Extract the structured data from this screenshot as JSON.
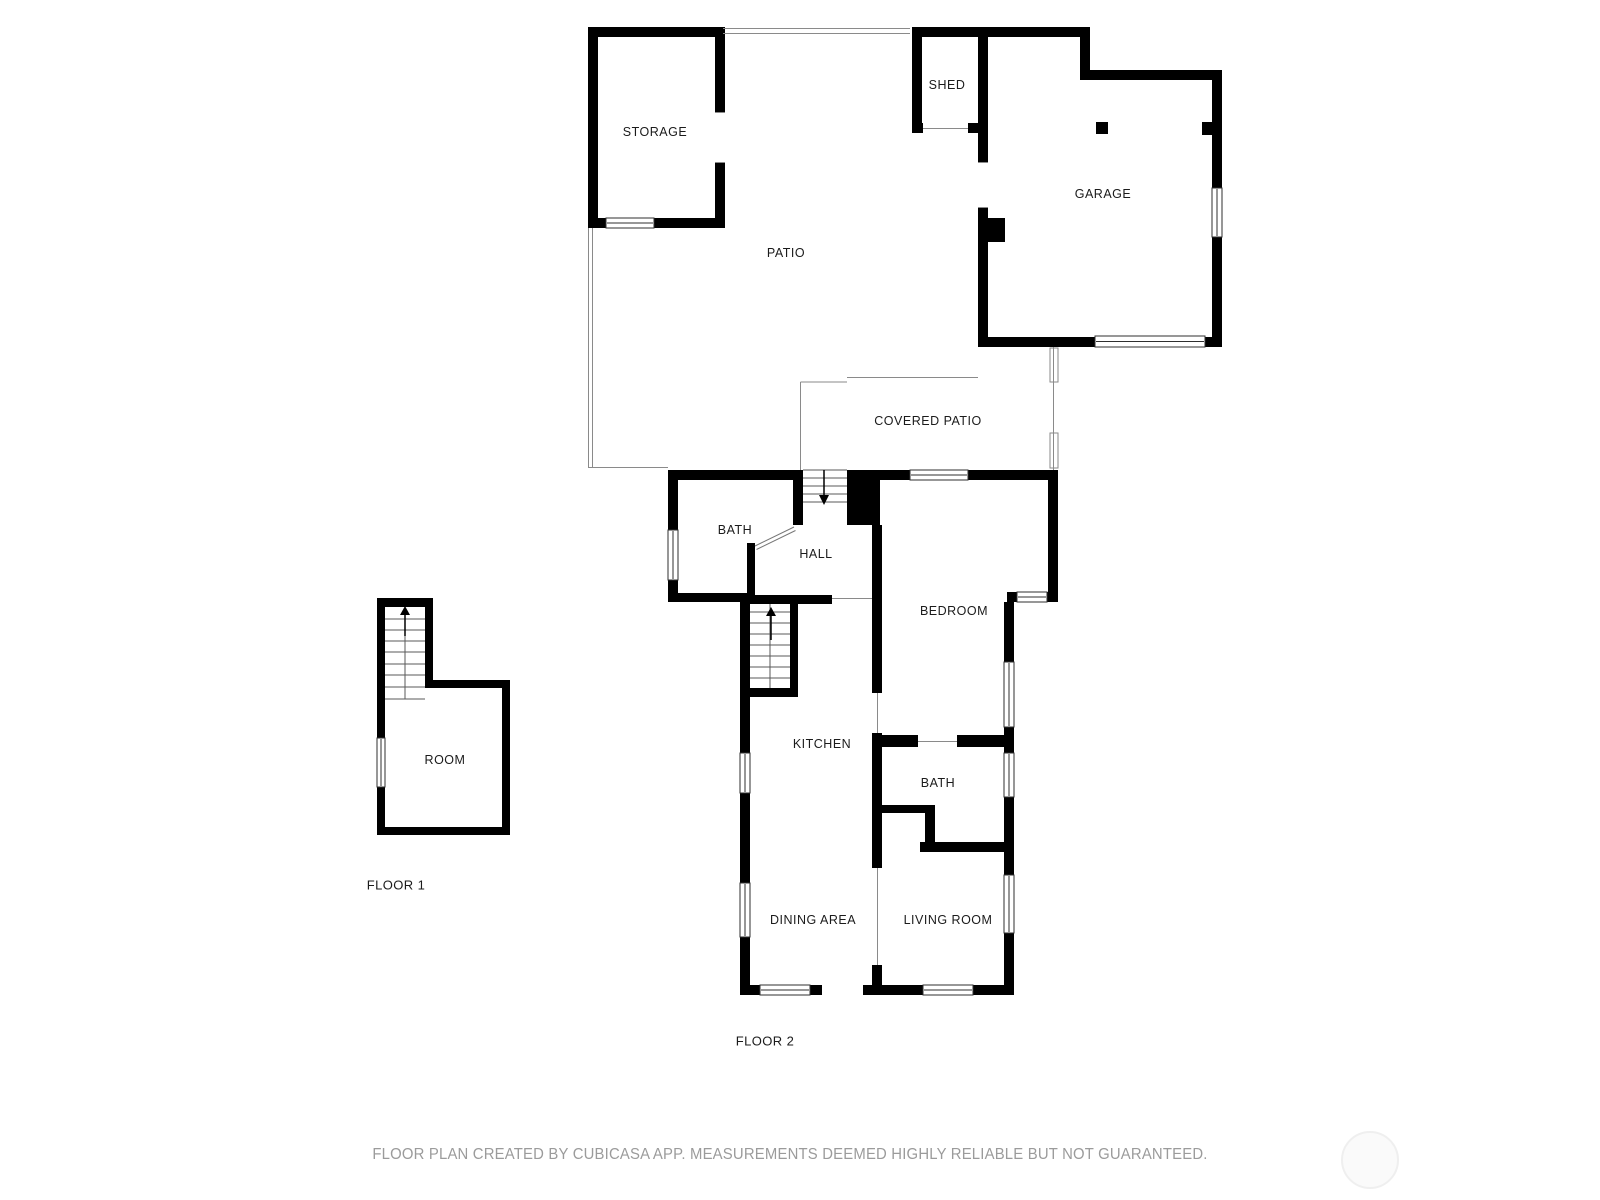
{
  "outdoor": {
    "storage": "STORAGE",
    "shed": "SHED",
    "garage": "GARAGE",
    "patio": "PATIO",
    "covered_patio": "COVERED PATIO"
  },
  "floor2": {
    "label": "FLOOR 2",
    "rooms": {
      "bath_upper": "BATH",
      "hall": "HALL",
      "bedroom": "BEDROOM",
      "kitchen": "KITCHEN",
      "bath_lower": "BATH",
      "dining_area": "DINING AREA",
      "living_room": "LIVING ROOM"
    }
  },
  "floor1": {
    "label": "FLOOR 1",
    "rooms": {
      "room": "ROOM"
    }
  },
  "footer": {
    "disclaimer": "FLOOR PLAN CREATED BY CUBICASA APP. MEASUREMENTS DEEMED HIGHLY RELIABLE BUT NOT GUARANTEED."
  },
  "colors": {
    "wall": "#000000",
    "thin_line": "#8a8a8a",
    "window_frame": "#2f2f2f",
    "label_text": "#1b1b1b",
    "disclaimer_text": "#9b9b9b",
    "background": "#ffffff",
    "watermark_fill": "#fafafa",
    "watermark_border": "#efefef"
  }
}
